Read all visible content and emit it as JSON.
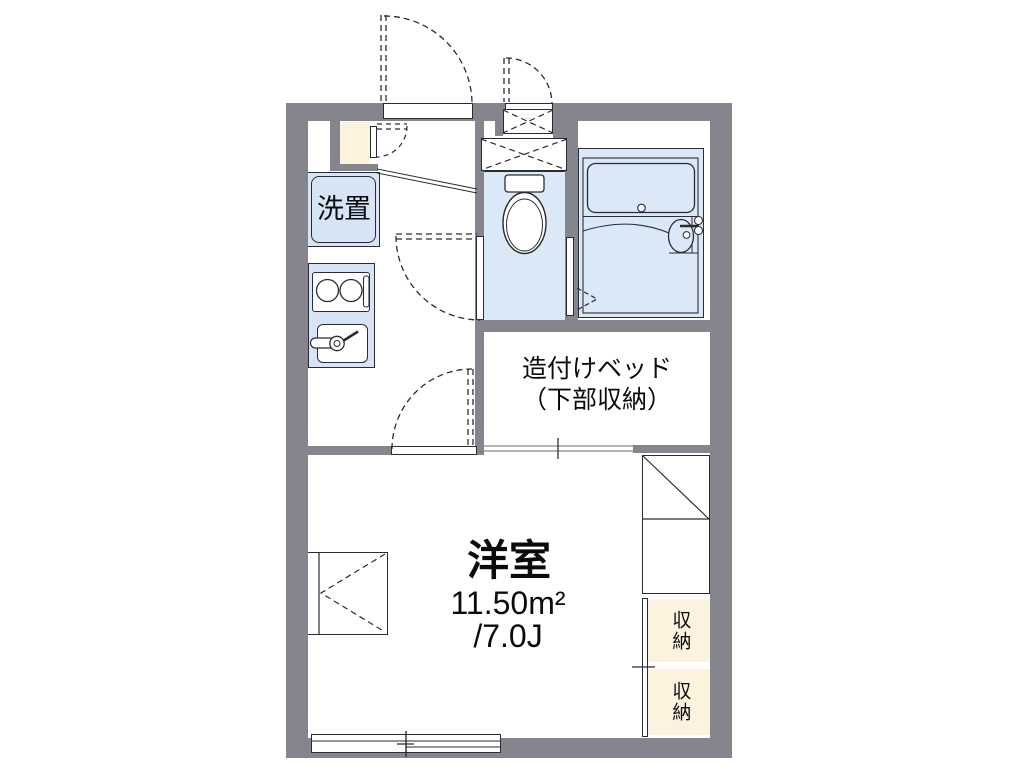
{
  "plan_title": "apartment-floor-plan",
  "labels": {
    "laundry": "洗置",
    "bed_line1": "造付けベッド",
    "bed_line2": "（下部収納）",
    "room_name": "洋室",
    "room_area": "11.50m²",
    "room_tatami": "/7.0J",
    "storage_top": "収納",
    "storage_bottom": "収納"
  },
  "colors": {
    "wall": "#85858d",
    "room": "#dbe8f8",
    "fixture": "#d6e4f6",
    "cream": "#fcf3de",
    "line": "#2b2b33",
    "ink": "#0b0b0e"
  },
  "fixtures": [
    "entrance-door",
    "shoe-cabinet-door",
    "laundry-machine-space",
    "gas-stove",
    "kitchen-sink",
    "toilet",
    "unit-bath",
    "bathtub",
    "washbasin",
    "hall-door",
    "room-door",
    "built-in-bed",
    "refrigerator-space",
    "casement-window",
    "sliding-window",
    "storage-sliding-door",
    "hatch-box"
  ]
}
